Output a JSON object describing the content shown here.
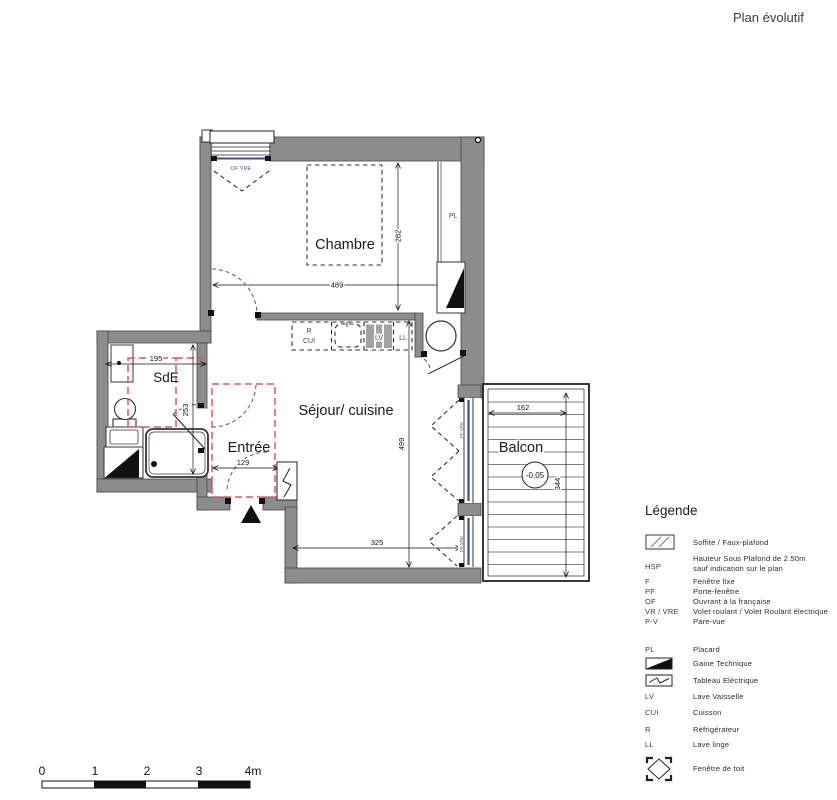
{
  "title": "Plan évolutif",
  "plan": {
    "room_labels": {
      "chambre": "Chambre",
      "sde": "SdE",
      "entree": "Entrée",
      "sejour": "Séjour/ cuisine",
      "balcon": "Balcon"
    },
    "dimensions": {
      "chambre_width": "489",
      "chambre_height": "282",
      "sde_width": "195",
      "sde_height": "253",
      "entree_width": "129",
      "sejour_width": "325",
      "sejour_height": "499",
      "balcon_width": "162",
      "balcon_height": "344"
    },
    "balcony_level": "-0.05",
    "equipment_labels": {
      "placard": "PL",
      "refrigerateur": "R",
      "cuisson": "CUI",
      "lave_vaisselle": "LV",
      "lave_linge": "LL",
      "window_top": "OF VRE",
      "window_balcony_upper": "PF VRE",
      "window_balcony_lower": "PF VRE"
    }
  },
  "legend": {
    "heading": "Légende",
    "items": [
      {
        "icon": "soffite-hatch-icon",
        "code": "",
        "label": "Soffite / Faux-plafond"
      },
      {
        "code": "HSP",
        "label": "Hauteur Sous Plafond de 2.50m",
        "label2": "sauf indication sur le plan"
      },
      {
        "code": "F",
        "label": "Fenêtre fixe"
      },
      {
        "code": "PF",
        "label": "Porte-fenêtre"
      },
      {
        "code": "OF",
        "label": "Ouvrant à la française"
      },
      {
        "code": "VR / VRE",
        "label": "Volet roulant / Volet Roulant électrique"
      },
      {
        "code": "P-V",
        "label": "Pare-vue"
      },
      {
        "code": "PL",
        "label": "Placard"
      },
      {
        "icon": "gaine-technique-icon",
        "code": "",
        "label": "Gaine Technique"
      },
      {
        "icon": "tableau-electrique-icon",
        "code": "",
        "label": "Tableau Eléctrique"
      },
      {
        "code": "LV",
        "label": "Lave Vaisselle"
      },
      {
        "code": "CUI",
        "label": "Cuisson"
      },
      {
        "code": "R",
        "label": "Réfrigérateur"
      },
      {
        "code": "LL",
        "label": "Lave linge"
      },
      {
        "icon": "roof-window-icon",
        "code": "",
        "label": "Fenêtre de toit"
      }
    ]
  },
  "scalebar": {
    "ticks": [
      "0",
      "1",
      "2",
      "3",
      "4m"
    ]
  },
  "colors": {
    "wall": "#8c8c8c",
    "red_dashed": "#e05858",
    "blue_door": "#5a5acc",
    "glazing": "#3a4f8f"
  }
}
